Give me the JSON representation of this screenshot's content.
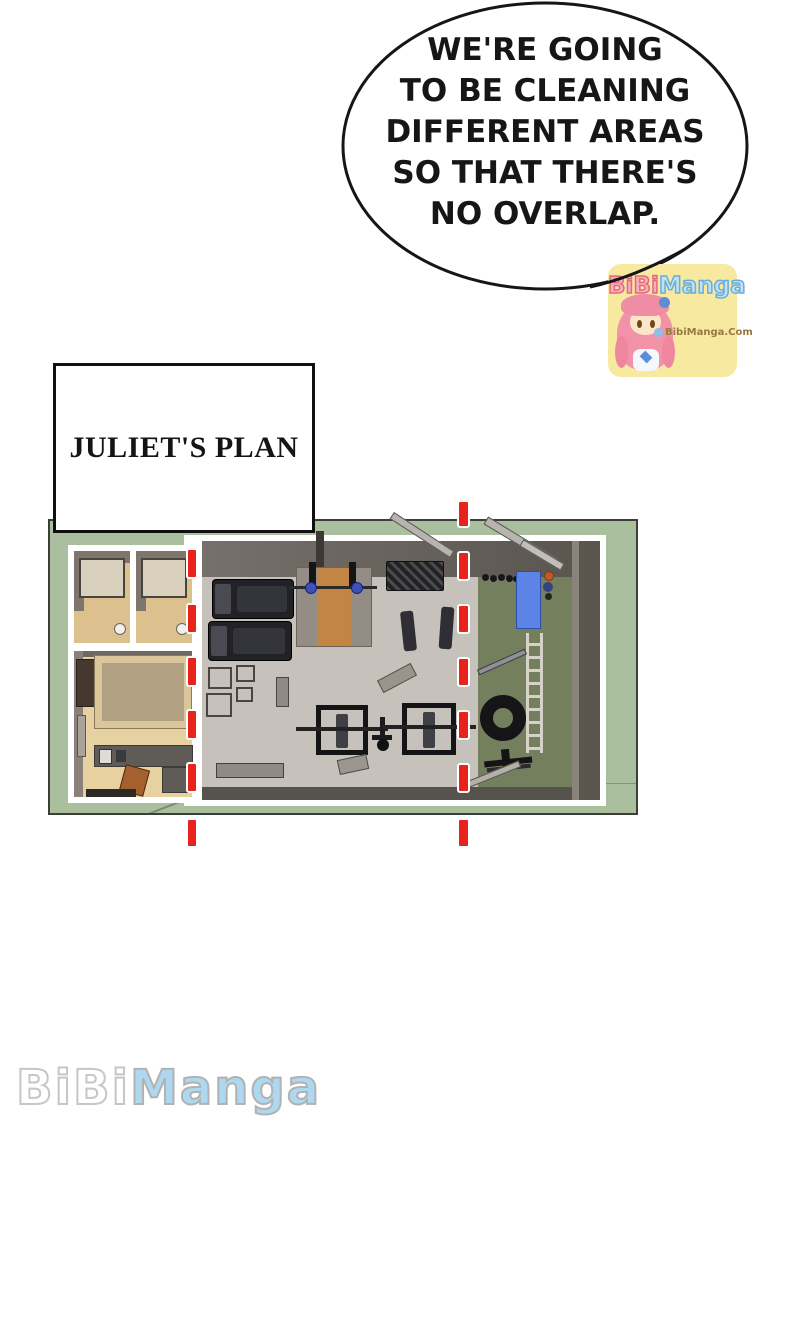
{
  "speech_bubble": {
    "text": "WE'RE GOING\nTO BE CLEANING\nDIFFERENT AREAS\nSO THAT THERE'S\nNO OVERLAP."
  },
  "plan_box": {
    "label": "JULIET'S PLAN"
  },
  "badge": {
    "brand_pink": "BiBi",
    "brand_blue": "Manga",
    "site": "BibiManga.Com"
  },
  "footer_watermark": {
    "white_part": "BiBi",
    "blue_part": "Manga"
  },
  "colors": {
    "page_bg": "#ffffff",
    "ground_green": "#a9bf9d",
    "turf_green": "#747f5e",
    "gym_floor_gray": "#c7c1bb",
    "wall_dark": "#5b5550",
    "wood_floor": "#e8d1a1",
    "divider_red": "#e7231c",
    "mat_blue": "#5d83e6",
    "badge_yellow": "#f8e9a1",
    "watermark_blue": "#aed7f0"
  }
}
